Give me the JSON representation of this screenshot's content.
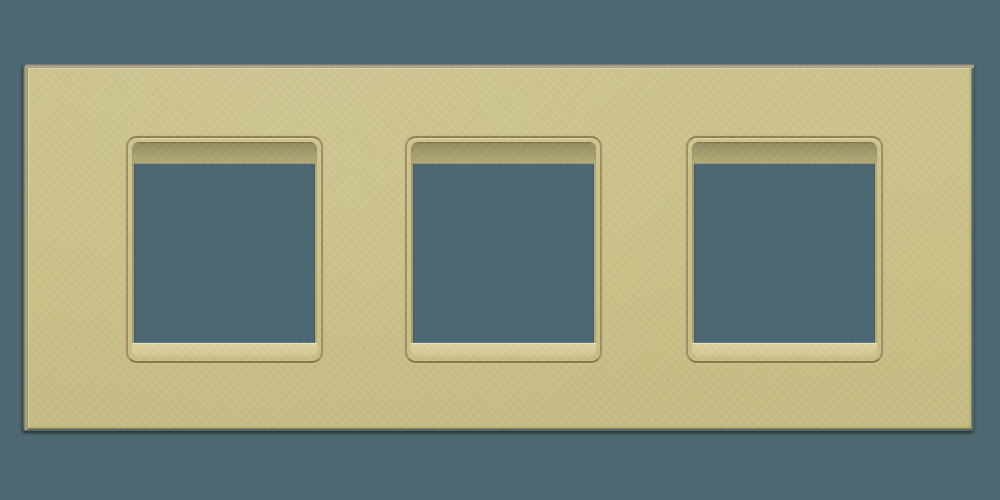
{
  "image": {
    "type_label": "product-render",
    "subject": "Triple-gang wall plate frame with three square openings, textured gold finish",
    "background_color": "#4d6872",
    "plate": {
      "finish": "textured gold",
      "base_color": "#c9c08a",
      "edge_side_color": "#a9a28d",
      "groove_color": "#8d7b4d",
      "recess_shadow_color": "#9d9367",
      "recess_highlight_color": "#d5cc96",
      "opening_count": 3
    },
    "openings": [
      {
        "id": "opening-1",
        "shape": "square",
        "fill_color": "#4d6872"
      },
      {
        "id": "opening-2",
        "shape": "square",
        "fill_color": "#4d6872"
      },
      {
        "id": "opening-3",
        "shape": "square",
        "fill_color": "#4d6872"
      }
    ]
  }
}
